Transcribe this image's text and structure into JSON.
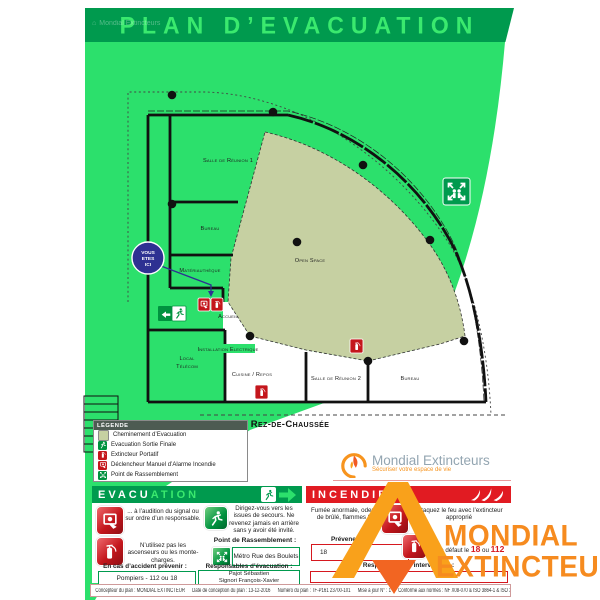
{
  "header": {
    "title": "PLAN D’EVACUATION",
    "brand_watermark": "Mondial Extincteurs"
  },
  "plan": {
    "floor_label": "Rez-de-Chaussée",
    "you_are_here": {
      "l1": "VOUS",
      "l2": "ETES",
      "l3": "ICI"
    },
    "rooms": {
      "reunion1": "Salle de Réunion 1",
      "bureau1": "Bureau",
      "materiautheque": "Matériauthèque",
      "accueil": "Accueil",
      "open_space": "Open Space",
      "installation_electrique": "Installation Electrique",
      "local_telecom_1": "Local",
      "local_telecom_2": "Télécom",
      "cuisine_repos": "Cuisine / Repos",
      "reunion2": "Salle de Réunion 2",
      "bureau2": "Bureau"
    }
  },
  "legend": {
    "title": "LÉGENDE",
    "items": [
      {
        "icon": "evacuation-path-chip",
        "label": "Cheminement d’Evacuation"
      },
      {
        "icon": "exit-icon",
        "label": "Evacuation Sortie Finale"
      },
      {
        "icon": "extinguisher-icon",
        "label": "Extincteur Portatif"
      },
      {
        "icon": "alarm-icon",
        "label": "Déclencheur Manuel d’Alarme Incendie"
      },
      {
        "icon": "assembly-point-icon",
        "label": "Point de Rassemblement"
      }
    ]
  },
  "brand": {
    "name": "Mondial Extincteurs",
    "tagline": "Sécuriser votre espace de vie"
  },
  "evacuation": {
    "title_a": "EVACU",
    "title_b": "ATION",
    "inst_signal": "... à l’audition du signal ou sur ordre d’un responsable.",
    "inst_elevator": "N’utilisez pas les ascenseurs ou les monte-charges.",
    "inst_exits": "Dirigez-vous vers les issues de secours. Ne revenez jamais en arrière sans y avoir été invité.",
    "assembly_label": "Point de Rassemblement :",
    "assembly_value": "Métro Rue des Boulets",
    "accident_label": "En cas d’accident prévenir :",
    "accident_value": "Pompiers - 112 ou 18",
    "resp_label": "Responsables d’évacuation :",
    "resp_1": "Pajot Sébastien",
    "resp_2": "Signori François-Xavier"
  },
  "incendie": {
    "title": "INCENDIE",
    "alert_text": "Fumée anormale, odeur de brûlé, flammes ?",
    "prevent_label": "Prévenez immédiatement",
    "phone_value": "18",
    "fallback_prefix": "ou à défaut le",
    "fallback_n1": "18",
    "fallback_sep": "ou",
    "fallback_n2": "112",
    "attack_text": "Attaquez le feu avec l’extincteur approprié",
    "intervention_label": "Responsables d’intervention :"
  },
  "watermark": {
    "line1": "MONDIAL",
    "line2": "EXTINCTEUR"
  },
  "footer": {
    "items": [
      "Concepteur du plan : MONDIAL EXTINCTEUR",
      "Date de conception du plan : 13-12-2016",
      "Numéro du plan : TF-P161 23700-101",
      "Mise à jour N° : 1",
      "Conforme aux normes : NF X08-070 & ISO 3864-1 & ISO 3864-3"
    ]
  },
  "colors": {
    "green": "#2ce06c",
    "dark_green": "#009a4e",
    "red": "#e11b22",
    "beige": "#c6d0a2",
    "blue": "#2e3192",
    "orange": "#f68b1f"
  }
}
